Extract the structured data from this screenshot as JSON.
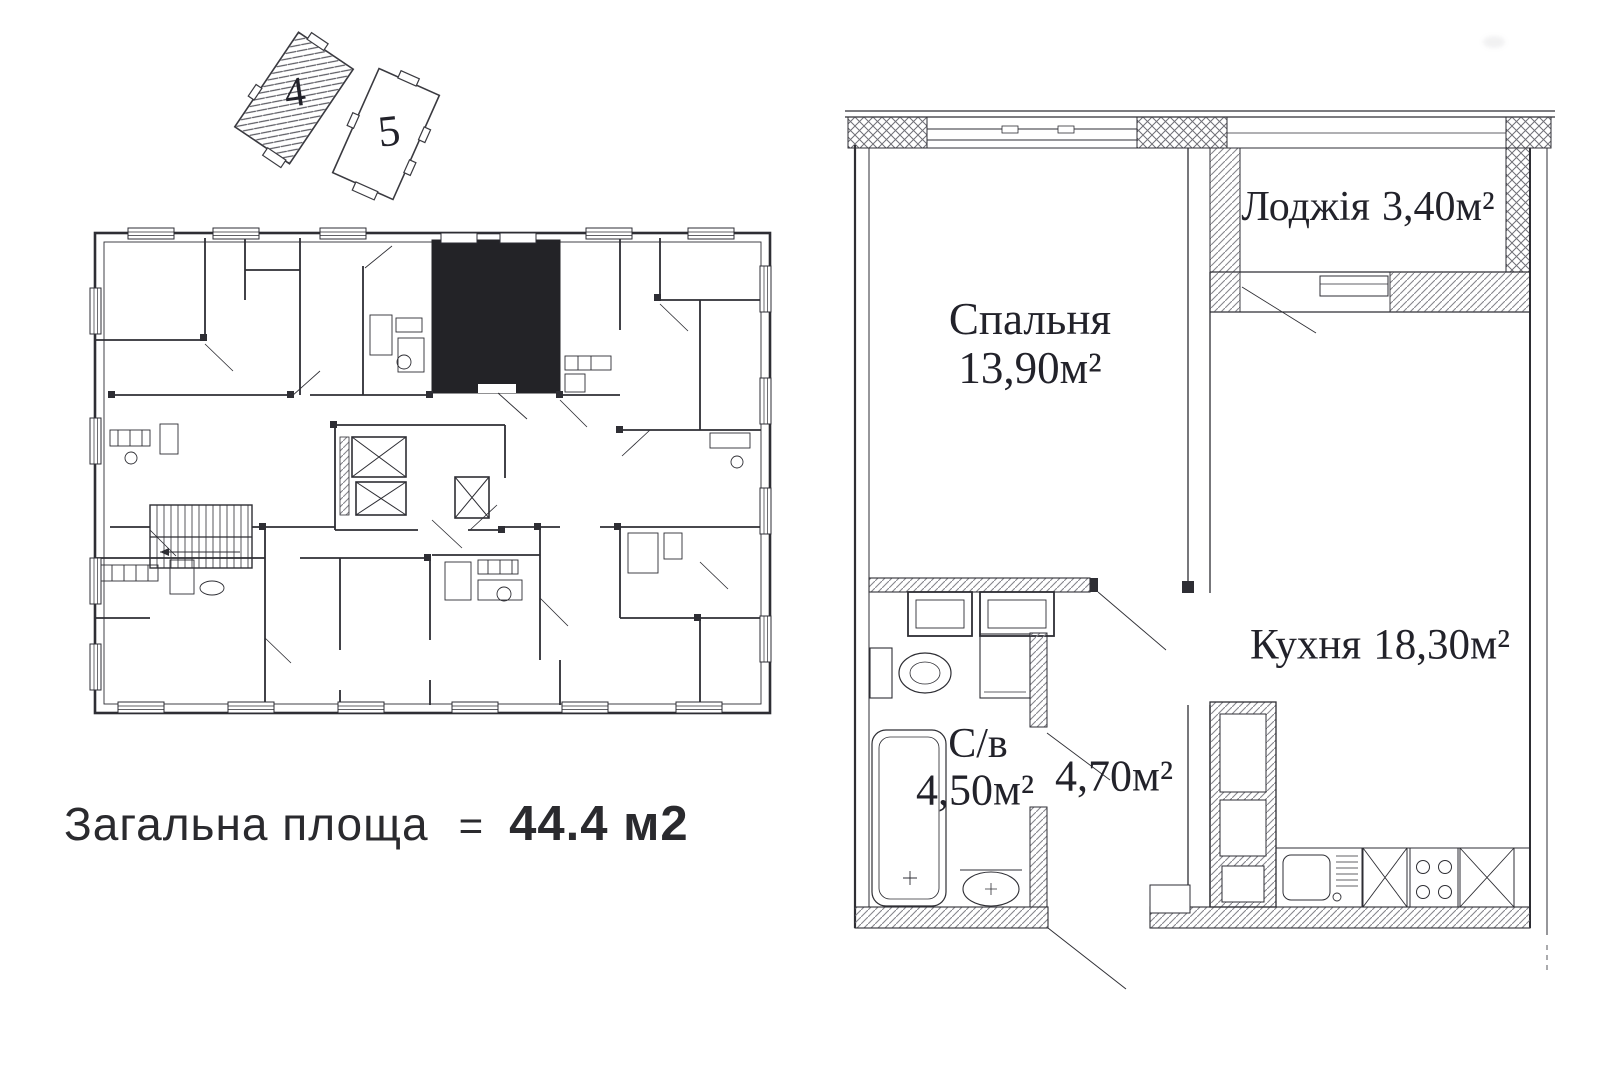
{
  "page": {
    "background": "#ffffff",
    "ink": "#2e2e34",
    "hatch": "#8b8b92",
    "highlight_fill": "#232327"
  },
  "site_plan": {
    "buildings": [
      {
        "label": "4"
      },
      {
        "label": "5"
      }
    ]
  },
  "apartment_plan": {
    "rooms": [
      {
        "name": "Лоджія",
        "area": "3,40м²"
      },
      {
        "name": "Спальня",
        "area": "13,90м²"
      },
      {
        "name": "Кухня",
        "area": "18,30м²"
      },
      {
        "name": "С/в",
        "area": "4,50м²"
      },
      {
        "name": "",
        "area": "4,70м²"
      }
    ],
    "fixtures": [
      "bathtub",
      "toilet",
      "washing-machine",
      "sink",
      "kitchen-sink",
      "stove",
      "kitchen-cabinet",
      "elevator",
      "staircase"
    ]
  },
  "summary": {
    "label": "Загальна площа",
    "equals": "=",
    "value": "44.4 м2"
  }
}
